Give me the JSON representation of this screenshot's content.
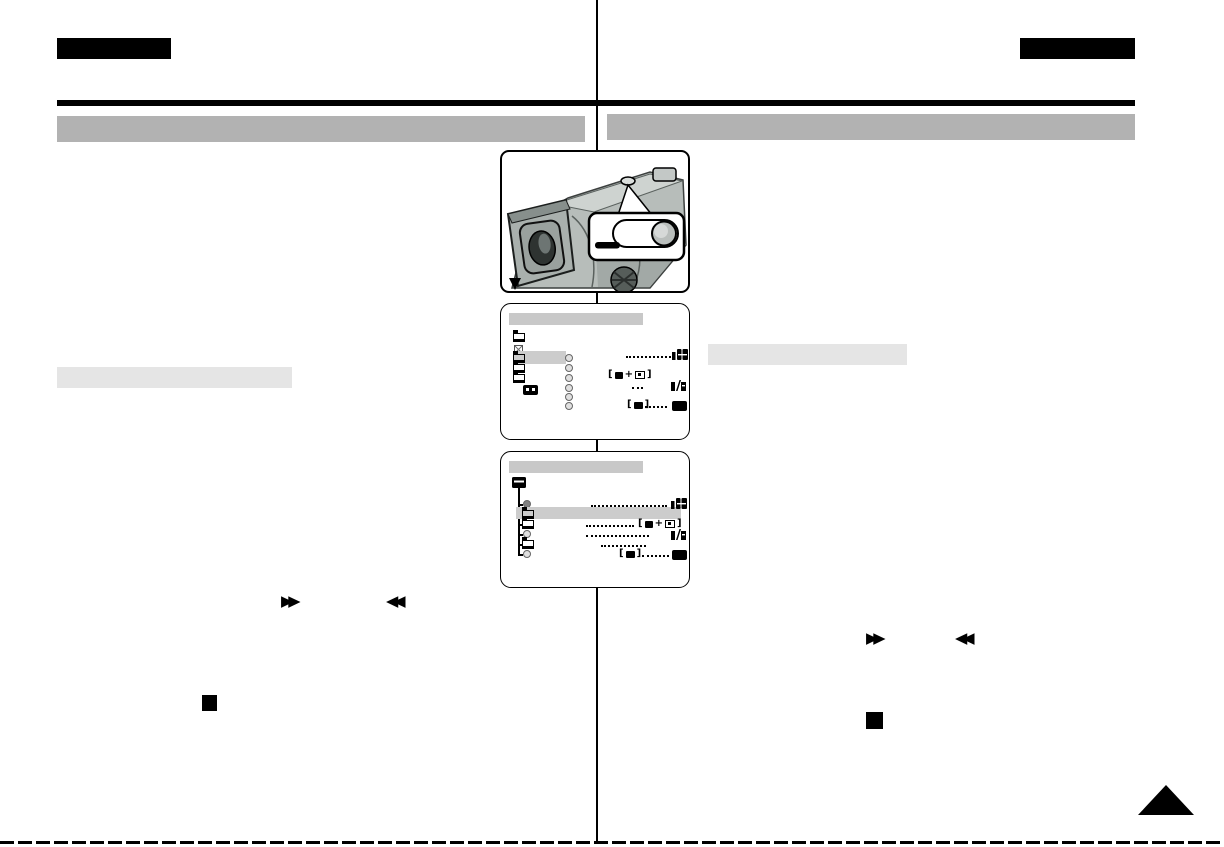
{
  "page": {
    "kind": "scanned camcorder user-manual page, two-column layout",
    "background": "#ffffff",
    "body_text_visible": false
  },
  "colors": {
    "ink": "#000000",
    "section_bar_gray": "#b2b2b2",
    "subsection_bar_gray": "#e5e5e5",
    "osd_title_gray": "#c8c8c8",
    "osd_highlight_gray": "#cccccc",
    "camera_body_gray": "#b7bdba",
    "camera_shadow_gray": "#8d9693"
  },
  "header": {
    "left_tab_label": "",
    "right_tab_label": "",
    "left_section_title": "",
    "right_section_title": ""
  },
  "subsections": {
    "left_subsection_title": "",
    "right_subsection_title": ""
  },
  "figures": {
    "camera": {
      "description": "top-rear view of camcorder with viewfinder; callout balloon showing an oval switch with round button and a black label pill"
    },
    "osd_menu_1": {
      "title": "",
      "left_icons": [
        "folder",
        "checkbox",
        "folder-selected",
        "folder",
        "folder",
        "memory-card"
      ],
      "radio_button_count": 6,
      "value_rows": [
        {
          "row": 1,
          "leader": "dotted",
          "value_icon": "tape-speed-badge"
        },
        {
          "row": 3,
          "value_icon": "tape-to-memory-badge"
        },
        {
          "row": 4,
          "leader": "dotted",
          "value_icon": "audio-bit-badge"
        },
        {
          "row": 6,
          "value_icon": "camcorder-badge",
          "leader": "dotted",
          "value_icon_2": "solid-black-badge"
        }
      ]
    },
    "osd_menu_2": {
      "title": "",
      "root_icon": "open-folder",
      "tree_rows": [
        "radio-selected",
        "folder-selected",
        "folder",
        "radio",
        "folder",
        "radio"
      ],
      "value_rows": [
        {
          "row": 1,
          "leader": "dotted",
          "value_icon": "tape-speed-badge"
        },
        {
          "row": 3,
          "leader": "dotted",
          "value_icon": "tape-to-memory-badge"
        },
        {
          "row": 4,
          "leader": "dotted",
          "value_icon": "audio-bit-badge"
        },
        {
          "row": 5,
          "leader": "dotted"
        },
        {
          "row": 6,
          "value_icon": "camcorder-badge",
          "leader": "dotted",
          "value_icon_2": "solid-black-badge"
        }
      ]
    }
  },
  "glyphs": {
    "fast_forward": "▶▶",
    "rewind": "◀◀",
    "stop": "■",
    "corner_marker": "▲"
  }
}
